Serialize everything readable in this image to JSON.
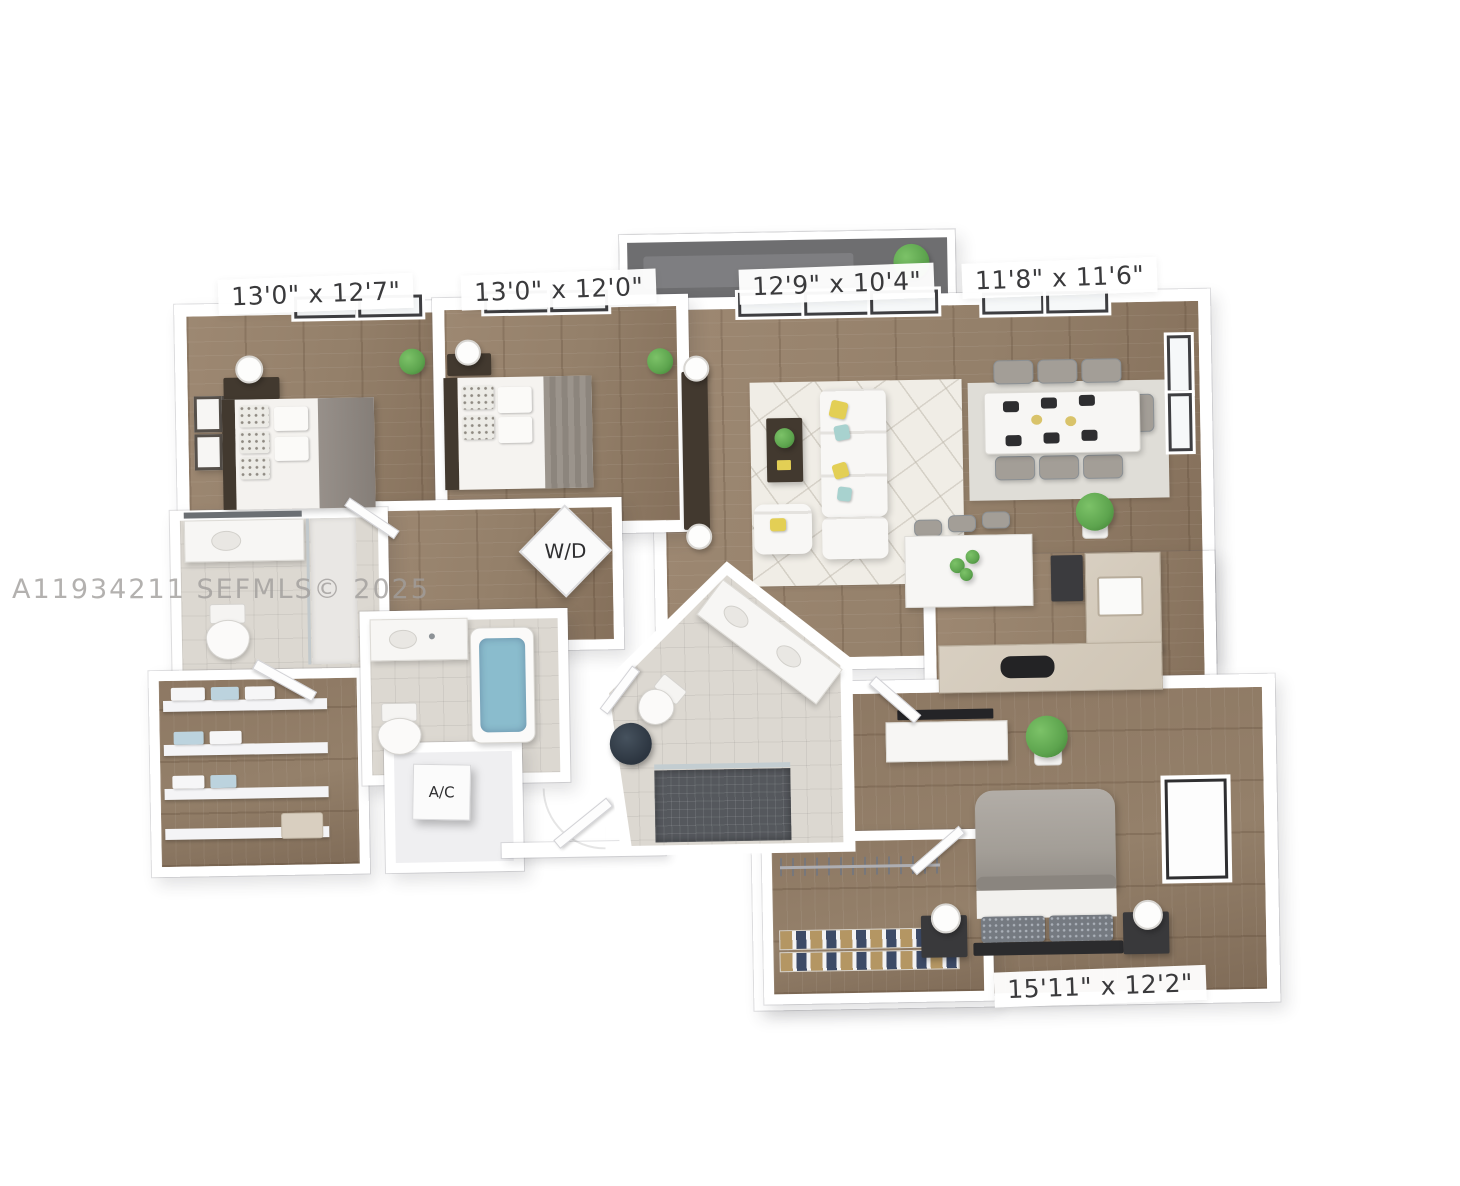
{
  "watermark": "A11934211  SEFMLS© 2025",
  "floor_plan": {
    "type": "3D rendered residential floor plan",
    "rooms": [
      {
        "name": "bedroom-1",
        "dimensions": "13'0\" x 12'7\""
      },
      {
        "name": "bedroom-2",
        "dimensions": "13'0\" x 12'0\""
      },
      {
        "name": "living-room",
        "dimensions": "12'9\" x 10'4\""
      },
      {
        "name": "dining-room",
        "dimensions": "11'8\" x 11'6\""
      },
      {
        "name": "primary-bedroom",
        "dimensions": "15'11\" x 12'2\""
      }
    ],
    "utilities": [
      {
        "name": "washer-dryer",
        "label": "W/D"
      },
      {
        "name": "air-conditioning",
        "label": "A/C"
      }
    ],
    "colors": {
      "wood_floor": "#94806a",
      "wall_white": "#ffffff",
      "tile_floor": "#dcd8d1",
      "balcony_floor": "#6e6e70",
      "rug_living": "#f0ede6",
      "rug_dining": "#dfddd7",
      "counter_beige": "#cfc5b5",
      "bathtub_blue": "#8abccd",
      "plant_green": "#5da44e",
      "pillow_yellow": "#e3cf55",
      "pillow_teal": "#a8d2cf",
      "dark_furniture": "#42392f",
      "gray_fabric": "#a39e97",
      "label_text": "#3a3a3c",
      "watermark_gray": "#a19e9c"
    }
  }
}
